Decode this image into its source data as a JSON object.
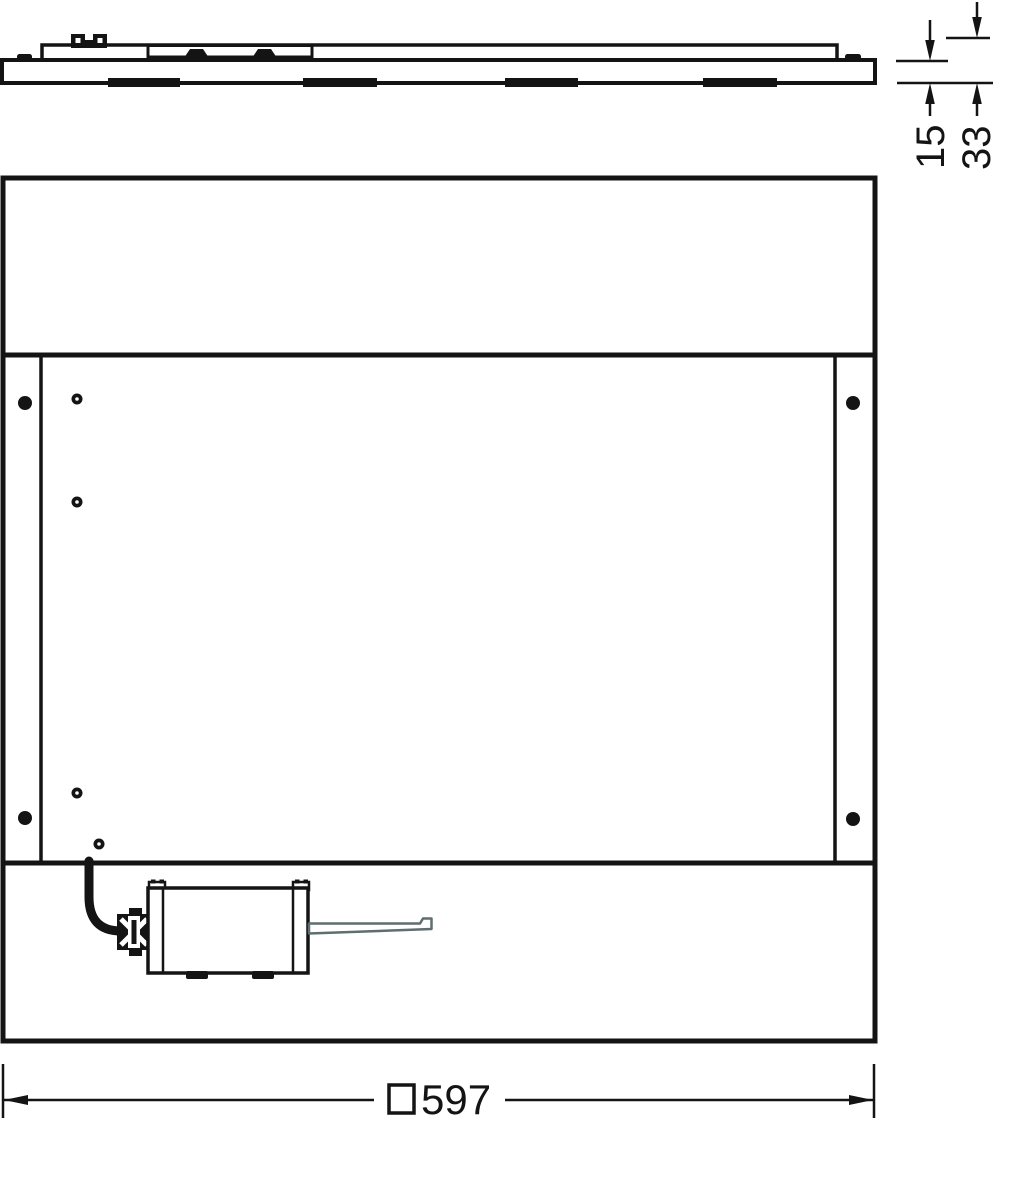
{
  "drawing": {
    "dimensions": {
      "panel_thickness": "15",
      "frame_total_height": "33",
      "width_symbol": "□",
      "width_value": "597"
    },
    "colors": {
      "line": "#141414",
      "wire_outline": "#5f6e6e",
      "background": "#ffffff"
    }
  }
}
